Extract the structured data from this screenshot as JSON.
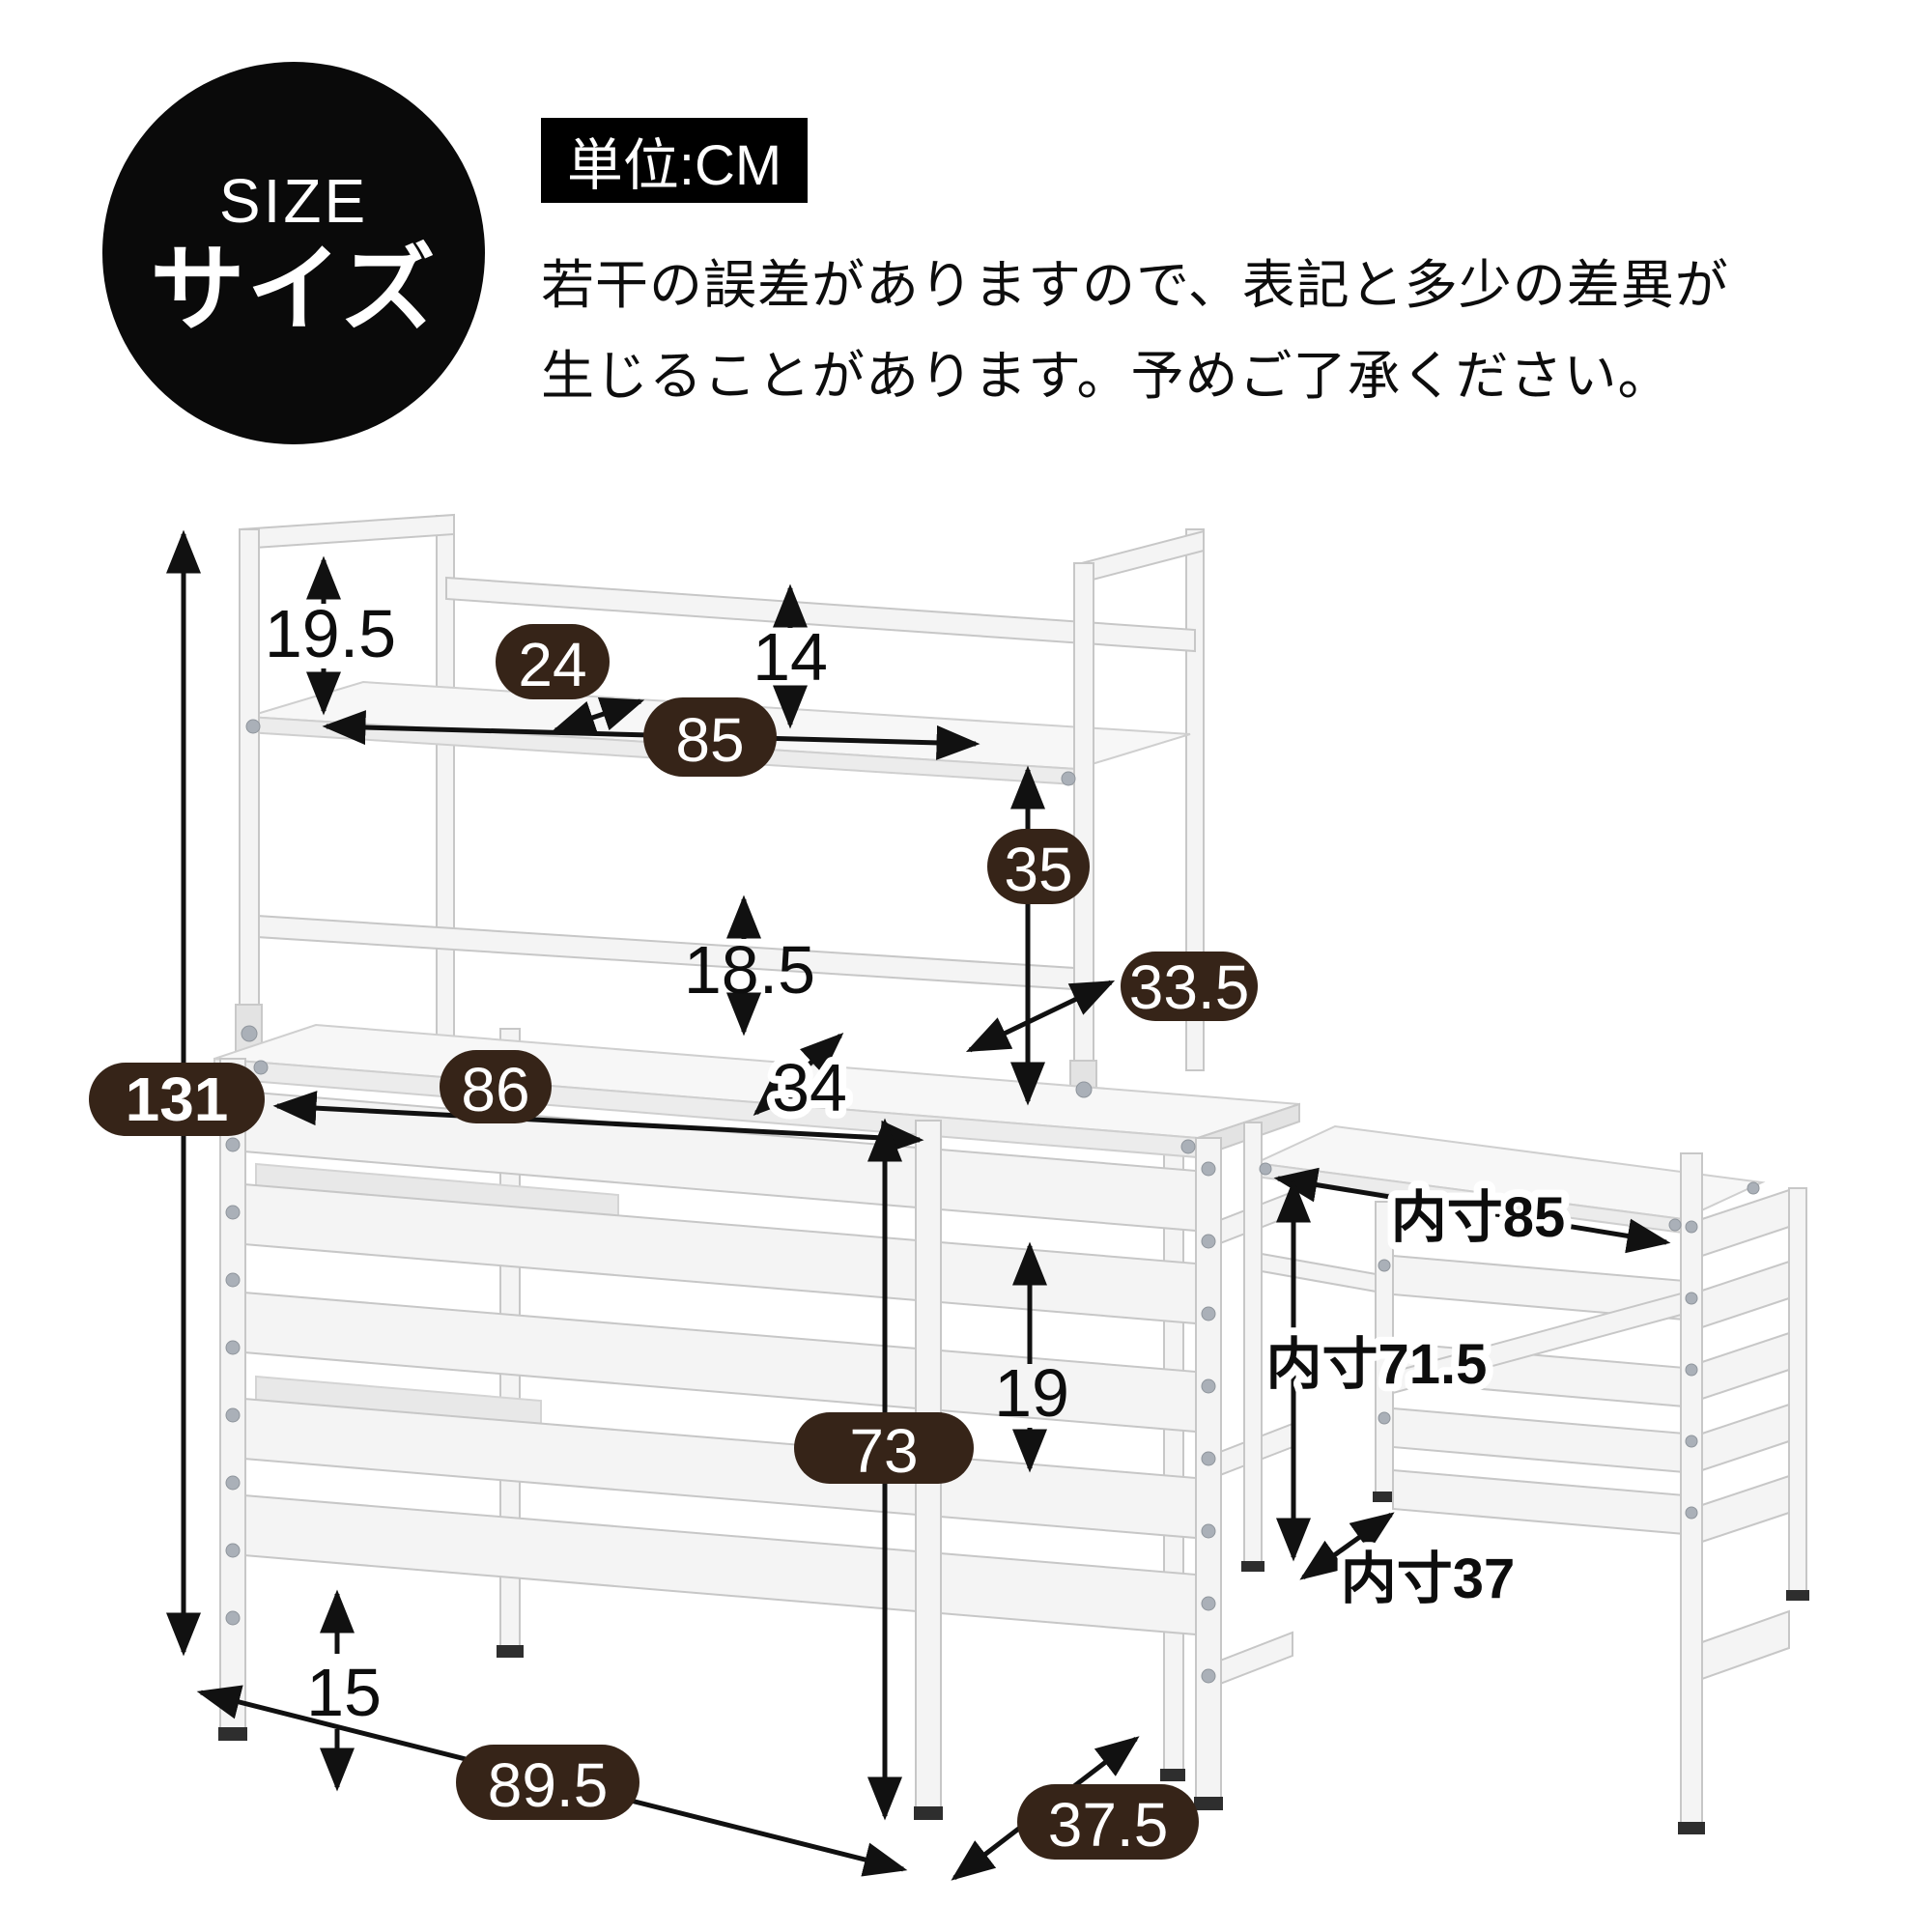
{
  "header": {
    "size_label_en": "SIZE",
    "size_label_ja": "サイズ",
    "unit_label": "単位:CM",
    "note_line1": "若干の誤差がありますので、表記と多少の差異が",
    "note_line2": "生じることがあります。予めご了承ください。"
  },
  "unit": "CM",
  "colors": {
    "badge_bg": "#362418",
    "arrow": "#111111",
    "ink": "#0d0d0d",
    "circle_bg": "#0a0a0a",
    "frame_stroke": "#c7c7c7",
    "frame_fill": "#f4f4f4"
  },
  "dimensions": {
    "total_height": "131",
    "hutch_side_height": "19.5",
    "top_shelf_depth": "24",
    "top_clearance": "14",
    "top_shelf_width": "85",
    "shelf_to_desktop": "35",
    "mid_rail_to_desktop": "18.5",
    "middle_shelf_depth": "33.5",
    "desktop_width": "86",
    "desktop_depth": "34",
    "desktop_height": "73",
    "side_rail_gap": "19",
    "bottom_clearance": "15",
    "outer_width": "89.5",
    "outer_depth": "37.5"
  },
  "inner_dimensions": {
    "width": "内寸85",
    "height": "内寸71.5",
    "depth": "内寸37"
  }
}
